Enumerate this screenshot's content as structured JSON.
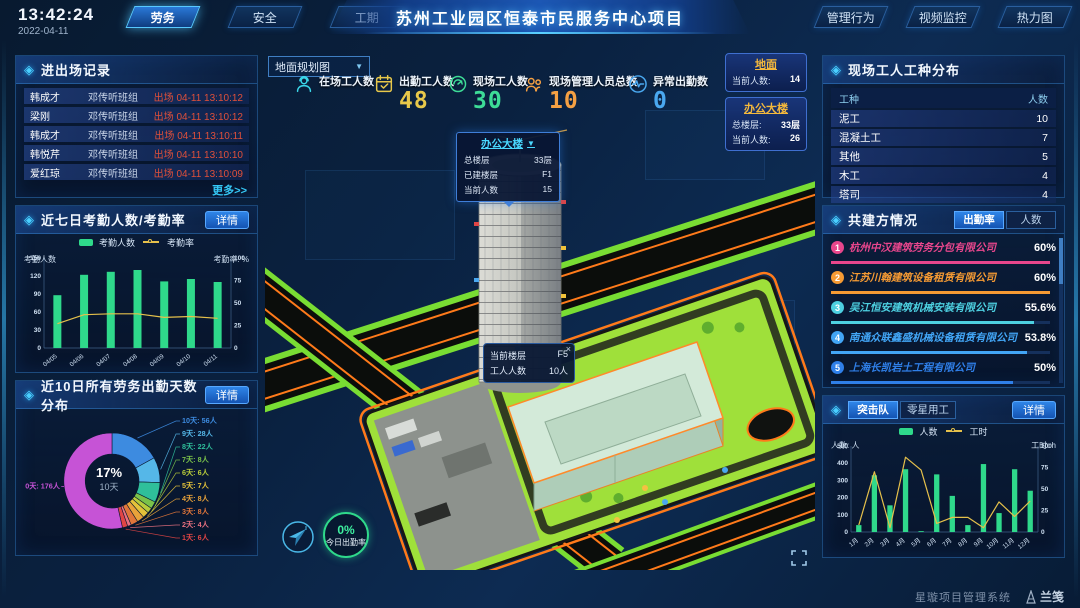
{
  "icons": {
    "panel_diamond": "◈",
    "caret_down": "▼",
    "close": "×",
    "more_arrow": "更多>>"
  },
  "header": {
    "time": "13:42:24",
    "date": "2022-04-11",
    "left_tabs": [
      {
        "label": "劳务",
        "active": true
      },
      {
        "label": "安全",
        "active": false
      },
      {
        "label": "工期",
        "active": false
      }
    ],
    "title": "苏州工业园区恒泰市民服务中心项目",
    "right_tabs": [
      {
        "label": "管理行为"
      },
      {
        "label": "视频监控"
      },
      {
        "label": "热力图"
      }
    ]
  },
  "left_column": {
    "entry_exit": {
      "title": "进出场记录",
      "more": "更多>>",
      "rows": [
        {
          "name": "韩成才",
          "group": "邓传听班组",
          "event": "出场 04-11 13:10:12"
        },
        {
          "name": "梁刚",
          "group": "邓传听班组",
          "event": "出场 04-11 13:10:12"
        },
        {
          "name": "韩成才",
          "group": "邓传听班组",
          "event": "出场 04-11 13:10:11"
        },
        {
          "name": "韩悦芹",
          "group": "邓传听班组",
          "event": "出场 04-11 13:10:10"
        },
        {
          "name": "爱红琼",
          "group": "邓传听班组",
          "event": "出场 04-11 13:10:09"
        }
      ]
    },
    "attendance": {
      "title": "近七日考勤人数/考勤率",
      "detail": "详情"
    },
    "distribution": {
      "title": "近10日所有劳务出勤天数分布",
      "detail": "详情"
    }
  },
  "center": {
    "map_select": "地面规划图",
    "stats": [
      {
        "label": "在场工人数",
        "value": "",
        "color": "#3ad6e8",
        "icon": "worker-icon"
      },
      {
        "label": "出勤工人数",
        "value": "48",
        "color": "#e8c84a",
        "icon": "calendar-check-icon"
      },
      {
        "label": "现场工人数",
        "value": "30",
        "color": "#3ddc97",
        "icon": "gauge-icon"
      },
      {
        "label": "现场管理人员总数",
        "value": "10",
        "color": "#f5a043",
        "icon": "people-icon"
      },
      {
        "label": "异常出勤数",
        "value": "0",
        "color": "#4aa8f0",
        "icon": "pulse-icon"
      }
    ],
    "location_cards": [
      {
        "title": "地面",
        "rows": [
          {
            "label": "当前人数:",
            "value": "14"
          }
        ]
      },
      {
        "title": "办公大楼",
        "rows": [
          {
            "label": "总楼层:",
            "value": "33层"
          },
          {
            "label": "当前人数:",
            "value": "26"
          }
        ]
      }
    ],
    "building_popup": {
      "title": "办公大楼",
      "rows": [
        {
          "label": "总楼层",
          "value": "33层"
        },
        {
          "label": "已建楼层",
          "value": "F1"
        },
        {
          "label": "当前人数",
          "value": "15"
        }
      ]
    },
    "floor_tooltip": {
      "rows": [
        {
          "label": "当前楼层",
          "value": "F5"
        },
        {
          "label": "工人人数",
          "value": "10人"
        }
      ]
    },
    "attendance_badge": {
      "value": "0%",
      "label": "今日出勤率"
    }
  },
  "right_column": {
    "worker_types": {
      "title": "现场工人工种分布",
      "columns": [
        "工种",
        "人数"
      ],
      "rows": [
        [
          "泥工",
          "10"
        ],
        [
          "混凝土工",
          "7"
        ],
        [
          "其他",
          "5"
        ],
        [
          "木工",
          "4"
        ],
        [
          "塔司",
          "4"
        ]
      ]
    },
    "partners": {
      "title": "共建方情况",
      "tabs": [
        {
          "label": "出勤率",
          "active": true
        },
        {
          "label": "人数",
          "active": false
        }
      ],
      "companies": [
        {
          "rank": "1",
          "name": "杭州中汉建筑劳务分包有限公司",
          "value": "60%",
          "pct": 60,
          "color": "#e8468c"
        },
        {
          "rank": "2",
          "name": "江苏川翰建筑设备租赁有限公司",
          "value": "60%",
          "pct": 60,
          "color": "#f59a33"
        },
        {
          "rank": "3",
          "name": "吴江恒安建筑机械安装有限公司",
          "value": "55.6%",
          "pct": 55.6,
          "color": "#4dd0e1"
        },
        {
          "rank": "4",
          "name": "南通众联鑫盛机械设备租赁有限公司",
          "value": "53.8%",
          "pct": 53.8,
          "color": "#42a5f5"
        },
        {
          "rank": "5",
          "name": "上海长凯岩土工程有限公司",
          "value": "50%",
          "pct": 50,
          "color": "#2f7fe8"
        },
        {
          "rank": "6",
          "name": "江苏法治建筑安装工程有限公司",
          "value": "35.4%",
          "pct": 35.4,
          "color": "#8a5ae0"
        }
      ]
    },
    "teams": {
      "tabs": [
        {
          "label": "突击队",
          "active": true
        },
        {
          "label": "零星用工",
          "active": false
        }
      ],
      "detail": "详情"
    }
  },
  "footer": {
    "system": "星璇项目管理系统",
    "brand": "兰笺"
  },
  "chart_data": [
    {
      "id": "attendance7",
      "type": "bar",
      "title": "近七日考勤人数/考勤率",
      "categories": [
        "04/05",
        "04/06",
        "04/07",
        "04/08",
        "04/09",
        "04/10",
        "04/11"
      ],
      "series": [
        {
          "name": "考勤人数",
          "type": "bar",
          "axis": "left",
          "values": [
            88,
            122,
            127,
            130,
            111,
            115,
            110
          ],
          "color": "#2fd98b"
        },
        {
          "name": "考勤率",
          "type": "line",
          "axis": "right",
          "values": [
            27,
            37,
            38,
            38,
            34,
            35,
            33
          ],
          "color": "#e5c04b"
        }
      ],
      "ylabel_left": "考勤人数",
      "ylabel_right": "考勤率: %",
      "left_ticks": [
        0,
        30,
        60,
        90,
        120,
        150
      ],
      "right_ticks": [
        0,
        25,
        50,
        75,
        100
      ],
      "ylim_left": [
        0,
        150
      ],
      "ylim_right": [
        0,
        100
      ],
      "legend_position": "top",
      "grid": false
    },
    {
      "id": "attendance_days_distribution",
      "type": "pie",
      "title": "近10日所有劳务出勤天数分布",
      "unit": "人",
      "center_value": "17%",
      "center_label": "10天",
      "slices": [
        {
          "label": "10天",
          "count": 56,
          "color": "#3d8be0"
        },
        {
          "label": "9天",
          "count": 28,
          "color": "#55b7e8"
        },
        {
          "label": "8天",
          "count": 22,
          "color": "#2fbf9a"
        },
        {
          "label": "7天",
          "count": 8,
          "color": "#7ac24a"
        },
        {
          "label": "6天",
          "count": 6,
          "color": "#b8cc3a"
        },
        {
          "label": "5天",
          "count": 7,
          "color": "#e3c23a"
        },
        {
          "label": "4天",
          "count": 8,
          "color": "#e8a23a"
        },
        {
          "label": "3天",
          "count": 8,
          "color": "#e0763a"
        },
        {
          "label": "2天",
          "count": 4,
          "color": "#e8707f"
        },
        {
          "label": "1天",
          "count": 6,
          "color": "#e04545"
        },
        {
          "label": "0天",
          "count": 176,
          "color": "#c653d6"
        }
      ]
    },
    {
      "id": "assault_team_monthly",
      "type": "bar",
      "title": "突击队",
      "categories": [
        "1月",
        "2月",
        "3月",
        "4月",
        "5月",
        "6月",
        "7月",
        "8月",
        "9月",
        "10月",
        "11月",
        "12月"
      ],
      "series": [
        {
          "name": "人数",
          "type": "bar",
          "axis": "left",
          "values": [
            40,
            330,
            155,
            365,
            5,
            335,
            210,
            40,
            395,
            110,
            365,
            240
          ],
          "color": "#2fd98b"
        },
        {
          "name": "工时",
          "type": "line",
          "axis": "right",
          "values": [
            8,
            70,
            5,
            87,
            72,
            10,
            17,
            17,
            5,
            35,
            18,
            36
          ],
          "color": "#e5c04b"
        }
      ],
      "ylabel_left": "人数: 人",
      "ylabel_right": "工时: h",
      "left_ticks": [
        0,
        100,
        200,
        300,
        400,
        500
      ],
      "right_ticks": [
        0,
        25,
        50,
        75,
        100
      ],
      "ylim_left": [
        0,
        500
      ],
      "ylim_right": [
        0,
        100
      ],
      "legend_position": "top",
      "grid": false
    }
  ]
}
